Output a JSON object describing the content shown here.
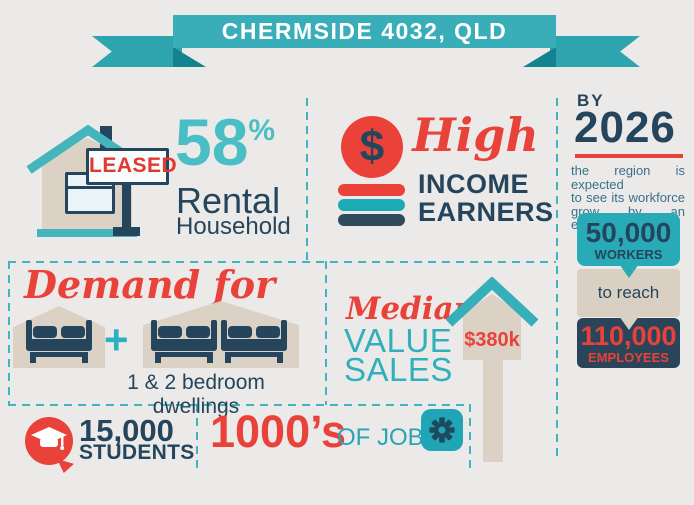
{
  "banner": {
    "title": "CHERMSIDE 4032, QLD"
  },
  "rental": {
    "sign_label": "LEASED",
    "percent": "58",
    "percent_sign": "%",
    "title_line1": "Rental",
    "title_line2": "Household"
  },
  "income": {
    "dollar": "$",
    "script_word": "High",
    "word1": "INCOME",
    "word2": "EARNERS"
  },
  "forecast": {
    "by_label": "BY",
    "year": "2026",
    "description_lines": [
      "the region is expected",
      "to see its workforce",
      "grow by an estimated"
    ],
    "workers_value": "50,000",
    "workers_label": "WORKERS",
    "to_reach_label": "to reach",
    "employees_value": "110,000",
    "employees_label": "EMPLOYEES"
  },
  "demand": {
    "script_title": "Demand for",
    "plus": "+",
    "caption": "1 & 2 bedroom dwellings"
  },
  "median": {
    "script_word": "Median",
    "word1": "VALUE",
    "word2": "SALES",
    "price": "$380k"
  },
  "students": {
    "value": "15,000",
    "label": "STUDENTS"
  },
  "jobs": {
    "value": "1000’s",
    "label": "OF JOBS"
  },
  "colors": {
    "teal": "#35AFB9",
    "teal_light": "#4ABEC5",
    "navy": "#24455C",
    "red": "#E8423A",
    "beige": "#DBD2C5",
    "background": "#ECEAE8"
  }
}
